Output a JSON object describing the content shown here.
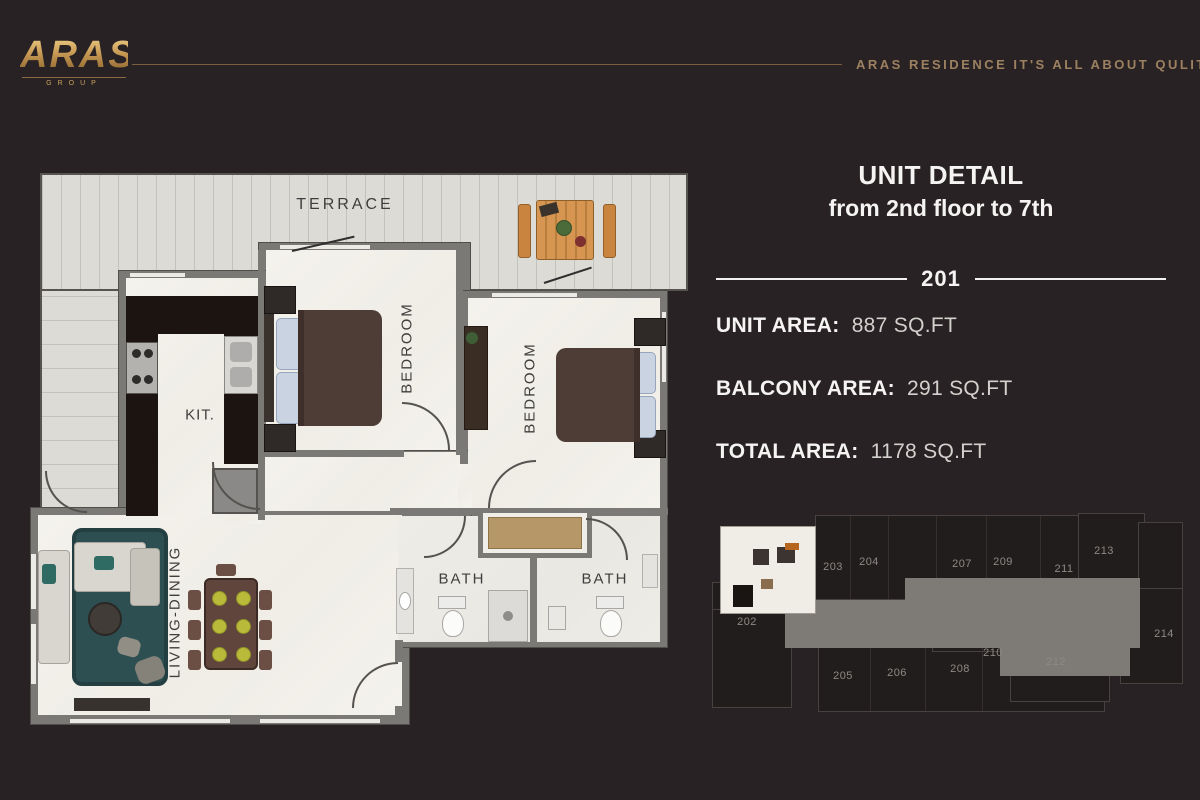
{
  "header": {
    "logo_brand": "ARAS",
    "logo_sub": "GROUP",
    "tagline": "ARAS RESIDENCE IT'S ALL ABOUT QULITY"
  },
  "unit_panel": {
    "title_line1": "UNIT DETAIL",
    "title_line2": "from 2nd floor to 7th",
    "unit_number": "201",
    "areas": [
      {
        "label": "UNIT AREA:",
        "value": "887 SQ.FT"
      },
      {
        "label": "BALCONY AREA:",
        "value": "291 SQ.FT"
      },
      {
        "label": "TOTAL AREA:",
        "value": "1178 SQ.FT"
      }
    ]
  },
  "floor_plan": {
    "labels": {
      "terrace": "TERRACE",
      "kitchen": "KIT.",
      "bedroom_1": "BEDROOM",
      "bedroom_2": "BEDROOM",
      "living": "LIVING-DINING",
      "bath_1": "BATH",
      "bath_2": "BATH"
    }
  },
  "minimap": {
    "highlighted_unit": "201",
    "units": [
      {
        "number": "202",
        "x": 37,
        "y": 114
      },
      {
        "number": "203",
        "x": 123,
        "y": 59
      },
      {
        "number": "204",
        "x": 159,
        "y": 54
      },
      {
        "number": "207",
        "x": 252,
        "y": 56
      },
      {
        "number": "209",
        "x": 293,
        "y": 54
      },
      {
        "number": "211",
        "x": 354,
        "y": 61
      },
      {
        "number": "213",
        "x": 394,
        "y": 43
      },
      {
        "number": "214",
        "x": 454,
        "y": 126
      },
      {
        "number": "205",
        "x": 133,
        "y": 168
      },
      {
        "number": "206",
        "x": 187,
        "y": 165
      },
      {
        "number": "208",
        "x": 250,
        "y": 161
      },
      {
        "number": "210",
        "x": 283,
        "y": 145
      },
      {
        "number": "212",
        "x": 346,
        "y": 154
      }
    ]
  },
  "colors": {
    "background": "#292224",
    "gold": "#c79b55",
    "gold_line": "#7a5f3e",
    "tagline": "#9c8161",
    "panel_text": "#f5f4f2",
    "panel_value": "#d3d1ce",
    "floor": "#f3f1eb",
    "terrace": "#dcdbd6",
    "wall": "#7b7976",
    "counter": "#1b1411",
    "rug": "#2e4f52",
    "sofa": "#d9d6cf",
    "bed": "#4e3c36",
    "pillow": "#c9d3e2",
    "plate": "#b9ba3a",
    "closet": "#b69868",
    "corridor": "#7e7a75",
    "minimap_unit": "#221d1d",
    "minimap_highlight": "#f0ece6"
  }
}
